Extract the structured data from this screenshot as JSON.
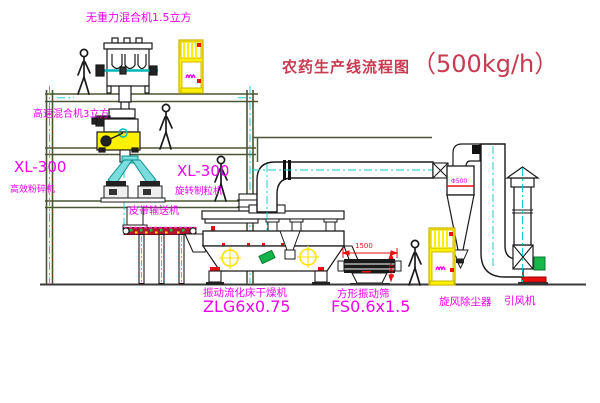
{
  "title": {
    "text": "农药生产线流程图",
    "capacity": "（500kg/h）"
  },
  "labels": {
    "top_mixer": "无重力混合机1.5立方",
    "hs_mixer": "高速混合机3立方",
    "mill_model": "XL-300",
    "mill_name": "高效粉碎机",
    "granulator_model": "XL-300",
    "granulator_name": "旋转制粒机",
    "belt": "皮带输送机",
    "dryer_name": "振动流化床干燥机",
    "dryer_model": "ZLG6x0.75",
    "sieve_name": "方形振动筛",
    "sieve_model": "FS0.6x1.5",
    "cyclone": "旋风除尘器",
    "cyclone_size": "Φ500",
    "fan": "引风机"
  },
  "dimensions": {
    "sieve_width": "1500",
    "sieve_height": "540"
  },
  "colors": {
    "label_magenta": "#ee00ee",
    "title_red": "#c83a50",
    "dimension_red": "#e81020",
    "centerline_cyan": "#00c8c8",
    "structure_olive": "#4a5534",
    "equipment_yellow": "#fdf000",
    "machine_black": "#1a1a1a",
    "motor_green": "#18b848",
    "conveyor_red": "#b51230"
  }
}
